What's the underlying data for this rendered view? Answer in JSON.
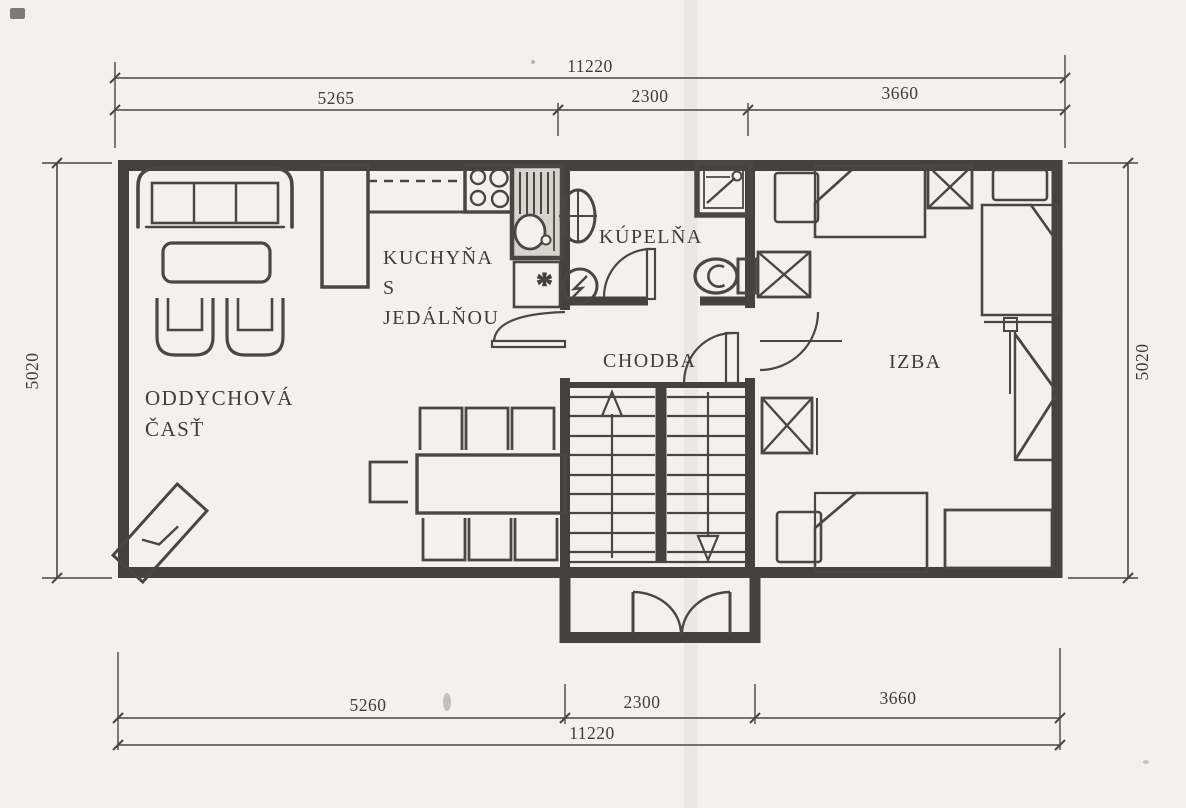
{
  "plan": {
    "type": "floor-plan",
    "language": "sk"
  },
  "rooms": {
    "lounge": {
      "label_line1": "ODDYCHOVÁ",
      "label_line2": "ČASŤ"
    },
    "kitchen": {
      "label_line1": "KUCHYŇA",
      "label_line2": "S",
      "label_line3": "JEDÁLŇOU"
    },
    "bathroom": {
      "label": "KÚPELŇA"
    },
    "hallway": {
      "label": "CHODBA"
    },
    "bedroom": {
      "label": "IZBA"
    }
  },
  "symbols": {
    "sink_note": "*"
  },
  "dimensions": {
    "top": {
      "overall": "11220",
      "segments": [
        "5265",
        "2300",
        "3660"
      ]
    },
    "bottom": {
      "overall": "11220",
      "segments": [
        "5260",
        "2300",
        "3660"
      ]
    },
    "left": {
      "height": "5020"
    },
    "right": {
      "height": "5020"
    }
  },
  "colors": {
    "paper": "#f3f1eb",
    "ink": "#4a4742",
    "wall": "#45423c"
  }
}
